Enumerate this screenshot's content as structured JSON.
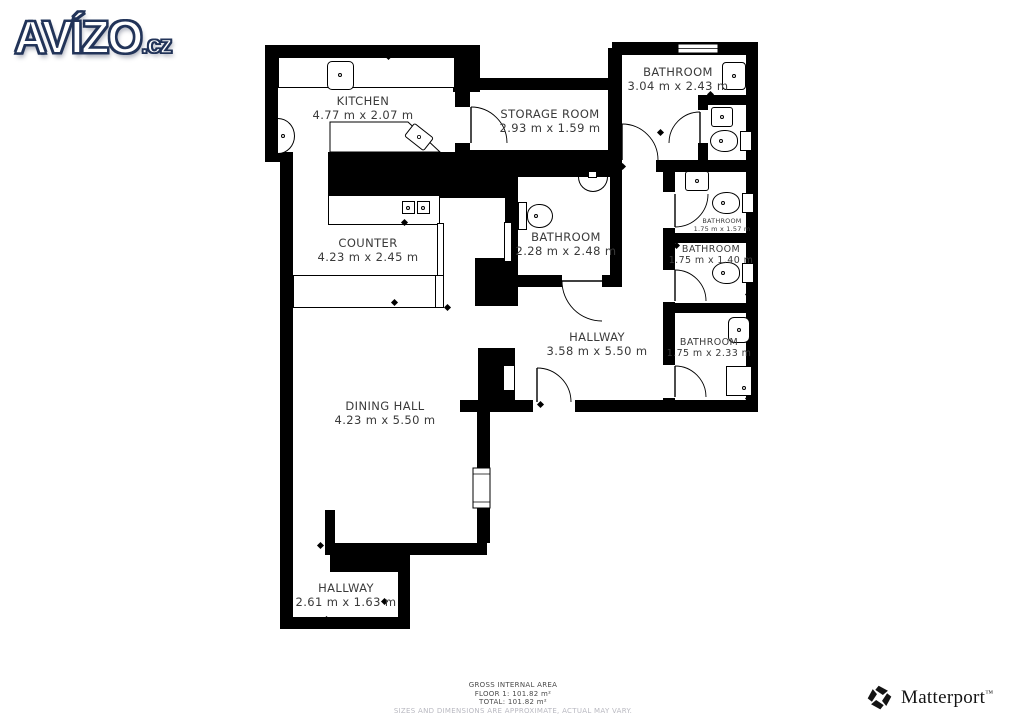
{
  "brand": {
    "avizo_main": "AVÍZO",
    "avizo_tld": ".cz",
    "matterport": "Matterport",
    "matterport_tm": "™"
  },
  "icons": {
    "matterport_mark": "pinwheel-logo"
  },
  "rooms": {
    "kitchen": {
      "name": "KITCHEN",
      "dims": "4.77 m x 2.07 m"
    },
    "storage": {
      "name": "STORAGE ROOM",
      "dims": "2.93 m x 1.59 m"
    },
    "bathroom_top": {
      "name": "BATHROOM",
      "dims": "3.04 m x 2.43 m"
    },
    "bathroom_mid": {
      "name": "BATHROOM",
      "dims": "2.28 m x 2.48 m"
    },
    "bathroom_r1": {
      "name": "BATHROOM",
      "dims": "1.75 m x 1.57 m"
    },
    "bathroom_r2": {
      "name": "BATHROOM",
      "dims": "1.75 m x 1.40 m"
    },
    "bathroom_r3": {
      "name": "BATHROOM",
      "dims": "1.75 m x 2.33 m"
    },
    "counter": {
      "name": "COUNTER",
      "dims": "4.23 m x 2.45 m"
    },
    "hallway_main": {
      "name": "HALLWAY",
      "dims": "3.58 m x 5.50 m"
    },
    "dining": {
      "name": "DINING HALL",
      "dims": "4.23 m x 5.50 m"
    },
    "hallway_bottom": {
      "name": "HALLWAY",
      "dims": "2.61 m x 1.63 m"
    }
  },
  "footer": {
    "area_title": "GROSS INTERNAL AREA",
    "floor": "FLOOR 1: 101.82 m²",
    "total": "TOTAL: 101.82 m²",
    "disclaimer": "SIZES AND DIMENSIONS ARE APPROXIMATE, ACTUAL MAY VARY."
  },
  "colors": {
    "wall": "#000000",
    "label": "#3a3a3a",
    "avizo_outline": "#223459",
    "disclaimer": "#b9b9c1"
  }
}
